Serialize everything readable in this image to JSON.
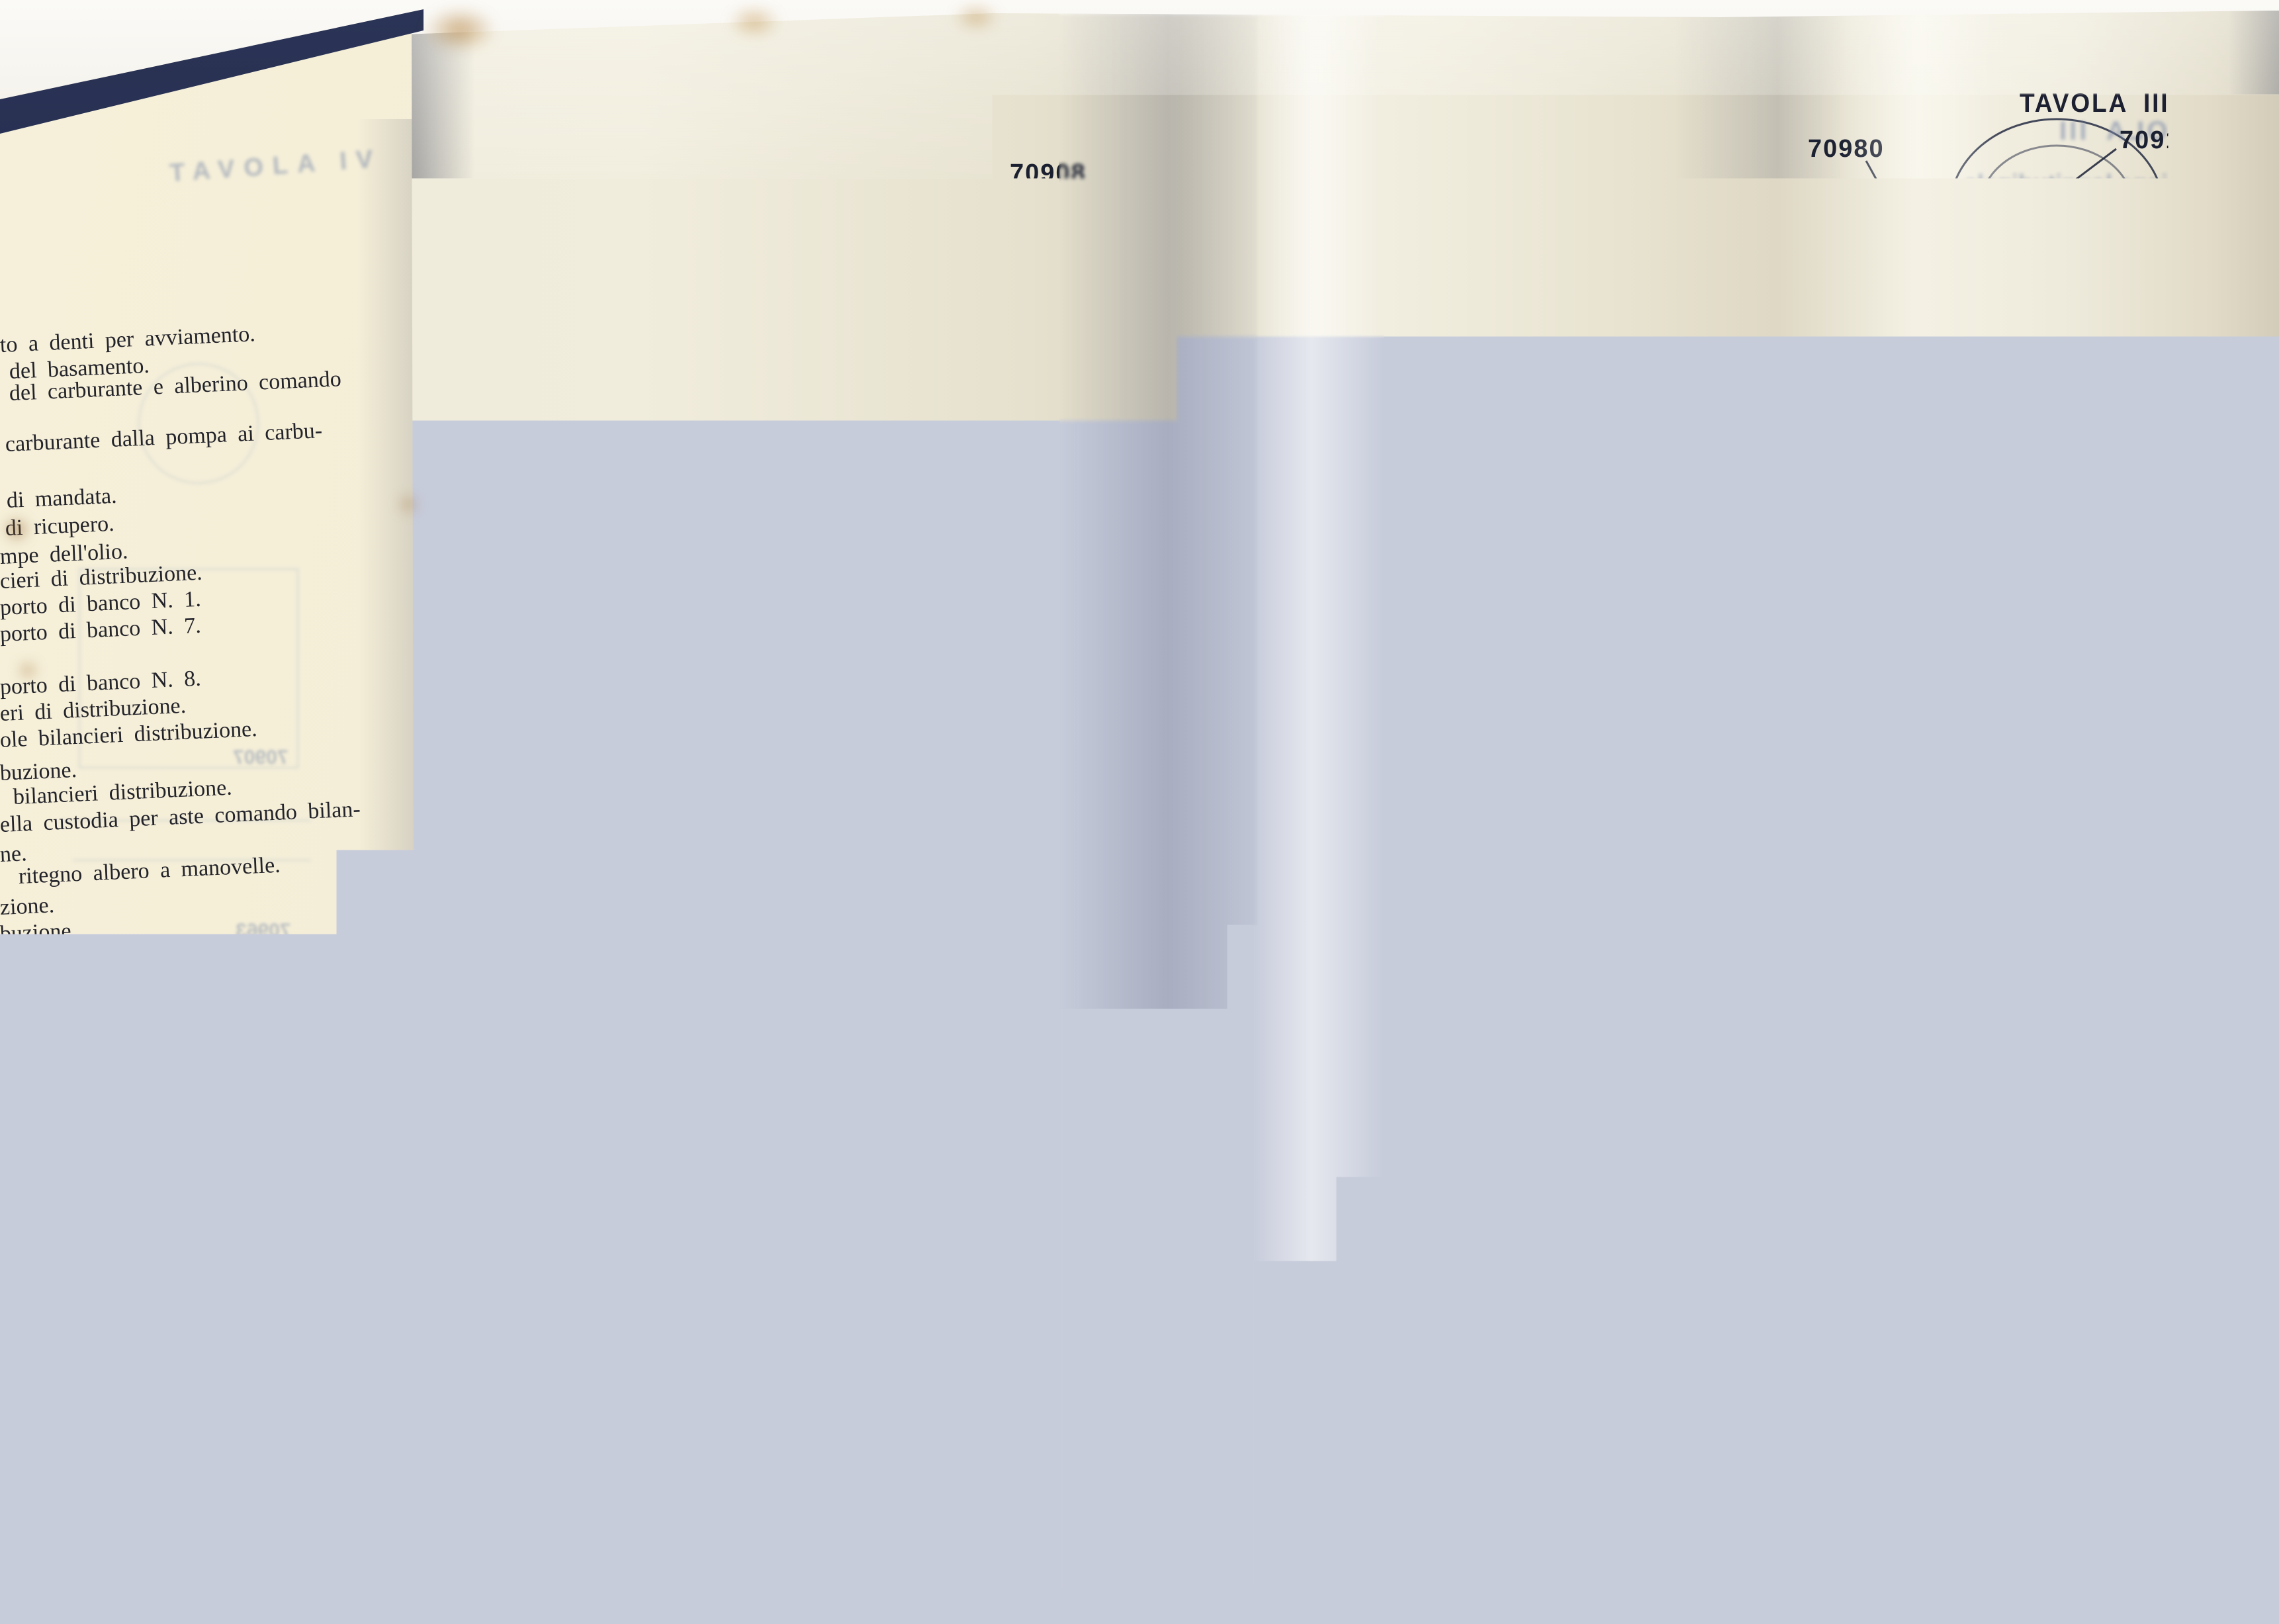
{
  "plate": {
    "header": "TAVOLA III",
    "caption": "SEZIONE LONGITUDINALE DEL MOTORE",
    "bleed_header": "TAVOLA III",
    "bleed_sub1": "Sezione longitudinale",
    "bleed_sub2": "del motore.",
    "bleed_footer": "MOTORE"
  },
  "left_page": {
    "bleed_header": "TAVOLA IV",
    "lines": [
      "to a denti per avviamento.",
      "del basamento.",
      "del carburante e alberino comando",
      "carburante dalla pompa ai carbu-",
      "di mandata.",
      "di ricupero.",
      "mpe dell'olio.",
      "cieri di distribuzione.",
      "porto di banco N. 1.",
      "porto di banco N. 7.",
      "porto di banco N. 8.",
      "eri di distribuzione.",
      "ole bilancieri distribuzione.",
      "buzione.",
      "bilancieri distribuzione.",
      "ella custodia per aste comando bilan-",
      "ne.",
      "ritegno albero a manovelle.",
      "zione.",
      "buzione.",
      "er comando magneti.",
      "ranaggio conico verticale comando",
      "aggi intermediari comando distribu-",
      "ggio intermediario comando magneti.",
      "di ausiliari.",
      "re per scatola comandi ausiliari.",
      "gamento per albero a manovelle.",
      "ante.",
      "do pompa carburante.",
      "teriore per fili accensione di sinistra.",
      "comandi ausiliari.",
      "nediario per comando magneti."
    ],
    "bleed_numbers": [
      "70907",
      "70963",
      "70960",
      "70995",
      "70999"
    ]
  },
  "part_labels": {
    "left": [
      "70913",
      "70981",
      "70872",
      "70802",
      "70905",
      "70807",
      "70873",
      "70910",
      "70906",
      "70808",
      "70907",
      "70803",
      "70901",
      "70895",
      "70897"
    ],
    "top": [
      "70812",
      "70908",
      "70980"
    ],
    "right": [
      "70918",
      "70919",
      "70870",
      "70920",
      "70811",
      "70935",
      "70936",
      "70813",
      "70833",
      "70909",
      "70858",
      "70860",
      "70861"
    ],
    "bottom": [
      "70887",
      "70900",
      "70899",
      "70949"
    ]
  }
}
